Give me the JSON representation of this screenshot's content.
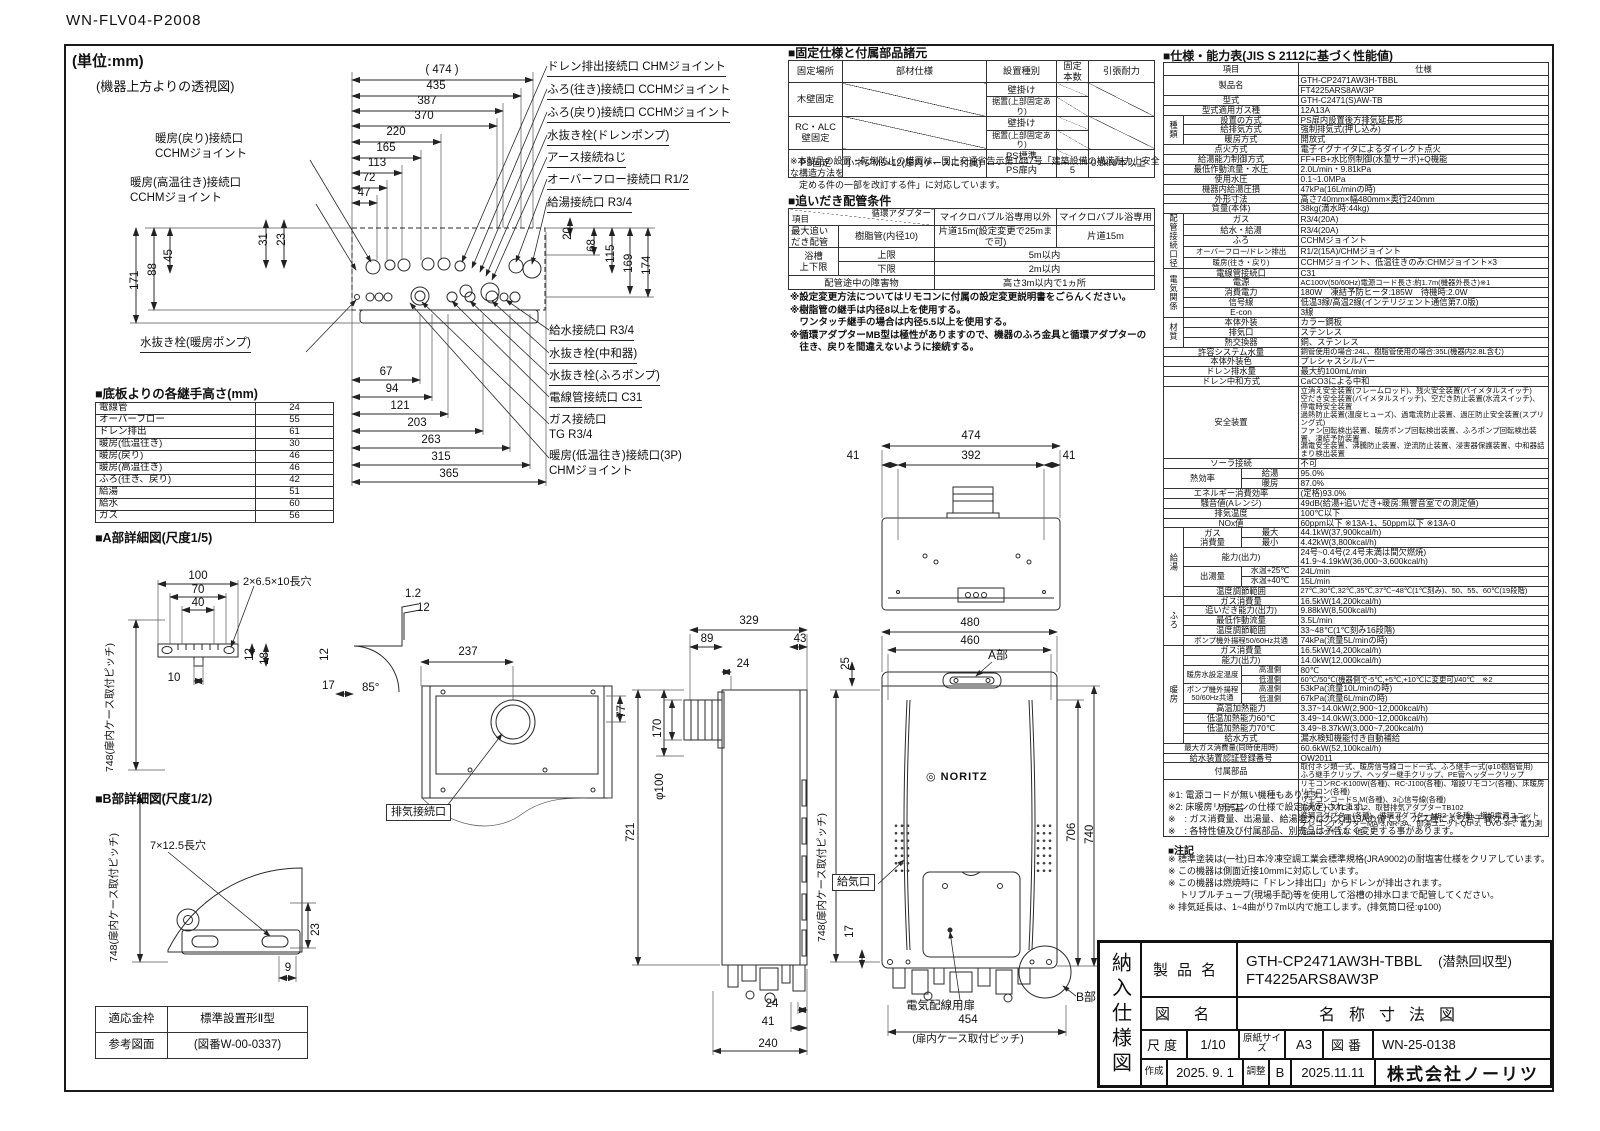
{
  "doc": {
    "code": "WN-FLV04-P2008",
    "unit": "(単位:mm)",
    "top_caption": "(機器上方よりの透視図)"
  },
  "top_view": {
    "dims_top": [
      "( 474 )",
      "435",
      "387",
      "370",
      "220",
      "165",
      "113",
      "72",
      "47"
    ],
    "dims_left": [
      "31",
      "23",
      "88",
      "45",
      "171"
    ],
    "dims_right": [
      "20",
      "68",
      "115",
      "169",
      "174"
    ],
    "dims_bottom": [
      "67",
      "94",
      "121",
      "203",
      "263",
      "315",
      "365"
    ],
    "labels_left": [
      "暖房(戻り)接続口\nCCHMジョイント",
      "暖房(高温往き)接続口\nCCHMジョイント",
      "水抜き栓(暖房ポンプ)"
    ],
    "labels_right": [
      "ドレン排出接続口 CHMジョイント",
      "ふろ(往き)接続口 CCHMジョイント",
      "ふろ(戻り)接続口 CCHMジョイント",
      "水抜き栓(ドレンポンプ)",
      "アース接続ねじ",
      "オーバーフロー接続口 R1/2",
      "給湯接続口 R3/4"
    ],
    "labels_right2": [
      "給水接続口 R3/4",
      "水抜き栓(中和器)",
      "水抜き栓(ふろポンプ)",
      "電線管接続口 C31",
      "ガス接続口\nTG R3/4",
      "暖房(低温往き)接続口(3P)\nCHMジョイント"
    ]
  },
  "joint_heights": {
    "title": "■底板よりの各継手高さ(mm)",
    "rows": [
      [
        "電線管",
        "24"
      ],
      [
        "オーバーフロー",
        "55"
      ],
      [
        "ドレン排出",
        "61"
      ],
      [
        "暖房(低温往き)",
        "30"
      ],
      [
        "暖房(戻り)",
        "46"
      ],
      [
        "暖房(高温往き)",
        "46"
      ],
      [
        "ふろ(往き、戻り)",
        "42"
      ],
      [
        "給湯",
        "51"
      ],
      [
        "給水",
        "60"
      ],
      [
        "ガス",
        "56"
      ]
    ]
  },
  "detail_a": {
    "title": "■A部詳細図(尺度1/5)",
    "pitch_full": "748(扉内ケース取付ピッチ)",
    "hole": "2×6.5×10長穴",
    "dims": [
      "100",
      "70",
      "40",
      "10",
      "12",
      "18",
      "1.2",
      "12",
      "12",
      "17",
      "85°"
    ]
  },
  "detail_b": {
    "title": "■B部詳細図(尺度1/2)",
    "pitch_full": "748(扉内ケース取付ピッチ)",
    "hole": "7×12.5長穴",
    "dims": [
      "23",
      "9"
    ]
  },
  "frame_table": {
    "rows": [
      [
        "適応金枠",
        "標準設置形Ⅱ型"
      ],
      [
        "参考図面",
        "(図番W-00-0337)"
      ]
    ]
  },
  "rear_view": {
    "dims": [
      "237",
      "77"
    ],
    "exhaust_label": "排気接続口"
  },
  "side_view": {
    "dims": [
      "329",
      "89",
      "43",
      "24",
      "170",
      "φ100",
      "721",
      "24",
      "41",
      "240"
    ]
  },
  "front_view": {
    "dims_top": [
      "474",
      "41",
      "392",
      "41"
    ],
    "dims": [
      "480",
      "460",
      "25",
      "706",
      "740",
      "17",
      "454"
    ],
    "pitch_full": "748(扉内ケース取付ピッチ)",
    "pitch454_note": "(扉内ケース取付ピッチ)",
    "labels": {
      "a": "A部",
      "b": "B部",
      "air": "給気口",
      "door": "電気配線用扉",
      "logo_mark": "◎",
      "logo": "NORITZ"
    }
  },
  "fixing": {
    "title": "■固定仕様と付属部品諸元",
    "headers": [
      "固定場所",
      "部材仕様",
      "設置種別",
      "固定本数",
      "引張耐力"
    ],
    "rows": [
      [
        {
          "t": "木壁固定",
          "rs": 2
        },
        {
          "t": "",
          "rs": 2,
          "cls": "diag"
        },
        {
          "t": "壁掛け"
        },
        {
          "t": "",
          "cls": "diag"
        },
        {
          "t": "",
          "rs": 2,
          "cls": "diag"
        }
      ],
      [
        {
          "t": "据置(上部固定あり)",
          "cls": "sm"
        },
        {
          "t": "",
          "cls": "diag"
        }
      ],
      [
        {
          "t": "RC・ALC\n壁固定",
          "rs": 2
        },
        {
          "t": "",
          "rs": 2,
          "cls": "diag"
        },
        {
          "t": "壁掛け"
        },
        {
          "t": "",
          "cls": "diag"
        },
        {
          "t": "",
          "rs": 2,
          "cls": "diag"
        }
      ],
      [
        {
          "t": "据置(上部固定あり)",
          "cls": "sm"
        },
        {
          "t": "",
          "cls": "diag"
        }
      ],
      [
        {
          "t": "PS固定",
          "rs": 2
        },
        {
          "t": "小ネジM5×12(扉内ケースに付属)",
          "rs": 2,
          "cls": "l"
        },
        {
          "t": "PS標準"
        },
        {
          "t": "",
          "cls": "diag"
        },
        {
          "t": "0.5kN/本以上",
          "rs": 2,
          "cls": "l"
        }
      ],
      [
        {
          "t": "PS扉内"
        },
        {
          "t": "5"
        }
      ]
    ],
    "note": "※本製品の設置・転倒防止の措置は、国土交通省告示第1447号「建築設備の構造耐力上安全な構造方法を\n　定める件の一部を改訂する件」に対応しています。"
  },
  "reheat": {
    "title": "■追いだき配管条件",
    "h_item": "項目",
    "h_adapter": "循環アダプター",
    "h_col1": "マイクロバブル浴専用以外",
    "h_col2": "マイクロバブル浴専用",
    "r1_label": "最大追い\nだき配管",
    "r1_adapter": "樹脂管(内径10)",
    "r1_v1": "片道15m(設定変更で25mまで可)",
    "r1_v2": "片道15m",
    "r2_label": "浴槽\n上下限",
    "r2_upper": "上限",
    "r2_upper_v": "5m以内",
    "r2_lower": "下限",
    "r2_lower_v": "2m以内",
    "r3_label": "配管途中の障害物",
    "r3_v": "高さ3m以内で1ヵ所",
    "notes": "※設定変更方法についてはリモコンに付属の設定変更説明書をごらんください。\n※樹脂管の継手は内径8以上を使用する。\n　ワンタッチ継手の場合は内径5.5以上を使用する。\n※循環アダプターMB型は極性がありますので、機器のふろ金具と循環アダプターの\n　往き、戻りを間違えないように接続する。"
  },
  "spec": {
    "title": "■仕様・能力表(JIS S 2112に基づく性能値)",
    "h_item": "項目",
    "h_val": "仕様",
    "rows": [
      [
        {
          "t": "製品名",
          "cs": 3,
          "rs": 2
        },
        {
          "t": "GTH-CP2471AW3H-TBBL",
          "cls": "l"
        }
      ],
      [
        {
          "t": "FT4225ARS8AW3P",
          "cls": "l"
        }
      ],
      [
        {
          "t": "型式",
          "cs": 3
        },
        {
          "t": "GTH-C2471(S)AW-TB",
          "cls": "l"
        }
      ],
      [
        {
          "t": "型式適用ガス種",
          "cs": 3
        },
        {
          "t": "12A13A",
          "cls": "l"
        }
      ],
      [
        {
          "t": "種類",
          "rs": 3
        },
        {
          "t": "設置の方式",
          "cs": 2
        },
        {
          "t": "PS扉内設置後方排気延長形",
          "cls": "l"
        }
      ],
      [
        {
          "t": "給排気方式",
          "cs": 2
        },
        {
          "t": "強制排気式(押し込み)",
          "cls": "l"
        }
      ],
      [
        {
          "t": "暖房方式",
          "cs": 2
        },
        {
          "t": "開放式",
          "cls": "l"
        }
      ],
      [
        {
          "t": "点火方式",
          "cs": 3
        },
        {
          "t": "電子イグナイタによるダイレクト点火",
          "cls": "l"
        }
      ],
      [
        {
          "t": "給湯能力制御方式",
          "cs": 3
        },
        {
          "t": "FF+FB+水比例制御(水量サーボ)+Q機能",
          "cls": "l"
        }
      ],
      [
        {
          "t": "最低作動流量・水圧",
          "cs": 3
        },
        {
          "t": "2.0L/min・9.81kPa",
          "cls": "l"
        }
      ],
      [
        {
          "t": "使用水圧",
          "cs": 3
        },
        {
          "t": "0.1~1.0MPa",
          "cls": "l"
        }
      ],
      [
        {
          "t": "機器内給湯圧損",
          "cs": 3
        },
        {
          "t": "47kPa(16L/minの時)",
          "cls": "l"
        }
      ],
      [
        {
          "t": "外形寸法",
          "cs": 3
        },
        {
          "t": "高さ740mm×幅480mm×奥行240mm",
          "cls": "l"
        }
      ],
      [
        {
          "t": "質量(本体)",
          "cs": 3
        },
        {
          "t": "38kg(満水時:44kg)",
          "cls": "l"
        }
      ],
      [
        {
          "t": "配管\n接続口径",
          "rs": 5
        },
        {
          "t": "ガス",
          "cs": 2
        },
        {
          "t": "R3/4(20A)",
          "cls": "l"
        }
      ],
      [
        {
          "t": "給水・給湯",
          "cs": 2
        },
        {
          "t": "R3/4(20A)",
          "cls": "l"
        }
      ],
      [
        {
          "t": "ふろ",
          "cs": 2
        },
        {
          "t": "CCHMジョイント",
          "cls": "l"
        }
      ],
      [
        {
          "t": "オーバーフロー/ドレン排出",
          "cs": 2,
          "cls": "xs"
        },
        {
          "t": "R1/2(15A)/CHMジョイント",
          "cls": "l"
        }
      ],
      [
        {
          "t": "暖房(往き・戻り)",
          "cs": 2,
          "cls": "xs"
        },
        {
          "t": "CCHMジョイント、低温往きのみ:CHMジョイント×3",
          "cls": "l"
        }
      ],
      [
        {
          "t": "電気関係",
          "rs": 5
        },
        {
          "t": "電線管接続口",
          "cs": 2
        },
        {
          "t": "C31",
          "cls": "l"
        }
      ],
      [
        {
          "t": "電源",
          "cs": 2
        },
        {
          "t": "AC100V(50/60Hz)電源コード長さ:約1.7m(機器外長さ)※1",
          "cls": "l xs"
        }
      ],
      [
        {
          "t": "消費電力",
          "cs": 2
        },
        {
          "t": "180W　凍結予防ヒータ:185W　待機時:2.0W",
          "cls": "l"
        }
      ],
      [
        {
          "t": "信号線",
          "cs": 2
        },
        {
          "t": "低温3線/高温2線(インテリジェント通信第7.0版)",
          "cls": "l"
        }
      ],
      [
        {
          "t": "E-con",
          "cs": 2
        },
        {
          "t": "3線",
          "cls": "l"
        }
      ],
      [
        {
          "t": "材質",
          "rs": 3
        },
        {
          "t": "本体外装",
          "cs": 2
        },
        {
          "t": "カラー鋼板",
          "cls": "l"
        }
      ],
      [
        {
          "t": "排気口",
          "cs": 2
        },
        {
          "t": "ステンレス",
          "cls": "l"
        }
      ],
      [
        {
          "t": "熱交換器",
          "cs": 2
        },
        {
          "t": "銅、ステンレス",
          "cls": "l"
        }
      ],
      [
        {
          "t": "許容システム水量",
          "cs": 3
        },
        {
          "t": "銅管使用の場合:24L、樹脂管使用の場合:35L(機器内2.8L含む)",
          "cls": "l xs"
        }
      ],
      [
        {
          "t": "本体外装色",
          "cs": 3
        },
        {
          "t": "プレシャスシルバー",
          "cls": "l"
        }
      ],
      [
        {
          "t": "ドレン排水量",
          "cs": 3
        },
        {
          "t": "最大約100mL/min",
          "cls": "l"
        }
      ],
      [
        {
          "t": "ドレン中和方式",
          "cs": 3
        },
        {
          "t": "CaCO3による中和",
          "cls": "l"
        }
      ],
      [
        {
          "t": "安全装置",
          "cs": 3
        },
        {
          "t": "立消え安全装置(フレームロッド)、残火安全装置(バイメタルスイッチ)\n空だき安全装置(バイメタルスイッチ)、空だき防止装置(水流スイッチ)、停電時安全装置\n過熱防止装置(温度ヒューズ)、過電流防止装置、過圧防止安全装置(スプリング式)\nファン回転検出装置、暖房ポンプ回転検出装置、ふろポンプ回転検出装置、凍結予防装置\n漏電安全装置、沸騰防止装置、逆流防止装置、浸害器保護装置、中和器詰まり検出装置",
          "cls": "l xs"
        }
      ],
      [
        {
          "t": "ソーラ接続",
          "cs": 3
        },
        {
          "t": "不可",
          "cls": "l"
        }
      ],
      [
        {
          "t": "熱効率",
          "cs": 2,
          "rs": 2
        },
        {
          "t": "給湯"
        },
        {
          "t": "95.0%",
          "cls": "l"
        }
      ],
      [
        {
          "t": "暖房"
        },
        {
          "t": "87.0%",
          "cls": "l"
        }
      ],
      [
        {
          "t": "エネルギー消費効率",
          "cs": 3
        },
        {
          "t": "(定格)93.0%",
          "cls": "l"
        }
      ],
      [
        {
          "t": "騒音値(Aレンジ)",
          "cs": 3
        },
        {
          "t": "49dB(給湯+追いだき+暖房:無響音室での測定値)",
          "cls": "l"
        }
      ],
      [
        {
          "t": "排気温度",
          "cs": 3
        },
        {
          "t": "100℃以下",
          "cls": "l"
        }
      ],
      [
        {
          "t": "NOx値",
          "cs": 3
        },
        {
          "t": "60ppm以下 ※13A-1、50ppm以下 ※13A-0",
          "cls": "l"
        }
      ],
      [
        {
          "t": "給湯",
          "rs": 6,
          "cls": "v"
        },
        {
          "t": "ガス\n消費量",
          "rs": 2
        },
        {
          "t": "最大"
        },
        {
          "t": "44.1kW(37,900kcal/h)",
          "cls": "l"
        }
      ],
      [
        {
          "t": "最小"
        },
        {
          "t": "4.42kW(3,800kcal/h)",
          "cls": "l"
        }
      ],
      [
        {
          "t": "能力(出力)",
          "cs": 2
        },
        {
          "t": "24号~0.4号(2.4号未満は間欠燃焼)\n41.9~4.19kW(36,000~3,600kcal/h)",
          "cls": "l"
        }
      ],
      [
        {
          "t": "出湯量",
          "rs": 2
        },
        {
          "t": "水温+25℃",
          "cls": "sm"
        },
        {
          "t": "24L/min",
          "cls": "l"
        }
      ],
      [
        {
          "t": "水温+40℃",
          "cls": "sm"
        },
        {
          "t": "15L/min",
          "cls": "l"
        }
      ],
      [
        {
          "t": "温度調節範囲",
          "cs": 2
        },
        {
          "t": "27℃,30℃,32℃,35℃,37℃~48℃(1℃刻み)、50、55、60℃(19段階)",
          "cls": "l xs"
        }
      ],
      [
        {
          "t": "ふろ",
          "rs": 5,
          "cls": "v"
        },
        {
          "t": "ガス消費量",
          "cs": 2
        },
        {
          "t": "16.5kW(14,200kcal/h)",
          "cls": "l"
        }
      ],
      [
        {
          "t": "追いだき能力(出力)",
          "cs": 2
        },
        {
          "t": "9.88kW(8,500kcal/h)",
          "cls": "l"
        }
      ],
      [
        {
          "t": "最低作動流量",
          "cs": 2
        },
        {
          "t": "3.5L/min",
          "cls": "l"
        }
      ],
      [
        {
          "t": "温度調節範囲",
          "cs": 2
        },
        {
          "t": "33~48℃(1℃刻み16段階)",
          "cls": "l"
        }
      ],
      [
        {
          "t": "ポンプ機外揚程50/60Hz共通",
          "cs": 2,
          "cls": "xs"
        },
        {
          "t": "74kPa(流量5L/minの時)",
          "cls": "l"
        }
      ],
      [
        {
          "t": "暖房",
          "rs": 10,
          "cls": "v"
        },
        {
          "t": "ガス消費量",
          "cs": 2
        },
        {
          "t": "16.5kW(14,200kcal/h)",
          "cls": "l"
        }
      ],
      [
        {
          "t": "能力(出力)",
          "cs": 2
        },
        {
          "t": "14.0kW(12,000kcal/h)",
          "cls": "l"
        }
      ],
      [
        {
          "t": "暖房水設定温度",
          "rs": 2,
          "cls": "xs"
        },
        {
          "t": "高温側",
          "cls": "xs"
        },
        {
          "t": "80℃",
          "cls": "l"
        }
      ],
      [
        {
          "t": "低温側",
          "cls": "xs"
        },
        {
          "t": "60℃/50℃(機器側で-5℃,+5℃,+10℃に変更可)/40℃　※2",
          "cls": "l xs"
        }
      ],
      [
        {
          "t": "ポンプ機外揚程\n50/60Hz共通",
          "rs": 2,
          "cls": "xs"
        },
        {
          "t": "高温側",
          "cls": "xs"
        },
        {
          "t": "53kPa(流量10L/minの時)",
          "cls": "l"
        }
      ],
      [
        {
          "t": "低温側",
          "cls": "xs"
        },
        {
          "t": "67kPa(流量6L/minの時)",
          "cls": "l"
        }
      ],
      [
        {
          "t": "高温加熱能力",
          "cs": 2
        },
        {
          "t": "3.37~14.0kW(2,900~12,000kcal/h)",
          "cls": "l"
        }
      ],
      [
        {
          "t": "低温加熱能力60℃",
          "cs": 2
        },
        {
          "t": "3.49~14.0kW(3,000~12,000kcal/h)",
          "cls": "l"
        }
      ],
      [
        {
          "t": "低温加熱能力70℃",
          "cs": 2
        },
        {
          "t": "3.49~8.37kW(3,000~7,200kcal/h)",
          "cls": "l"
        }
      ],
      [
        {
          "t": "給水方式",
          "cs": 2
        },
        {
          "t": "漏水検知機能付き自動補給",
          "cls": "l"
        }
      ],
      [
        {
          "t": "最大ガス消費量(同時使用時)",
          "cs": 3,
          "cls": "xs"
        },
        {
          "t": "60.6kW(52,100kcal/h)",
          "cls": "l"
        }
      ],
      [
        {
          "t": "給水装置認証登録番号",
          "cs": 3
        },
        {
          "t": "OW2011",
          "cls": "l"
        }
      ],
      [
        {
          "t": "付属部品",
          "cs": 3
        },
        {
          "t": "取付ネジ類一式、暖房信号線コード一式、ふろ継手一式(φ10樹脂管用)\nふろ継手クリップ、ヘッダー継手クリップ、PE管ヘッダークリップ",
          "cls": "l xs"
        }
      ],
      [
        {
          "t": "別売品",
          "cs": 3
        },
        {
          "t": "リモコンRC-K100W(各種)、RC-J100(各種)、増設リモコン(各種)、床暖房リモコン(各種)\nリモコンコードS,M(各種)、3心信号線(各種)\n扉内ケースTC-13,12、取替排気アダプターTB102\n循環アダプター(各種)、循環アダプターMB2-1(各種)、増設電源ユニット\nテレコンアダプターMA-3,NR-3A、即湯ユニットQU-3、DVU-3F、電力測定ユニット1,2　他",
          "cls": "l xs"
        }
      ]
    ],
    "notes": "※1: 電源コードが無い機種もあります。\n※2: 床暖房リモコンの仕様で設定(決定)されます。\n※　: ガス消費量、出湯量、給湯能力はガス種13Aの値です。ガス種により若干異なります。\n※　: 各特性値及び付属部品、別売品は予告なく変更する事があります。",
    "notes2_title": "■注記",
    "notes2": "※ 標準塗装は(一社)日本冷凍空調工業会標準規格(JRA9002)の耐塩害仕様をクリアしています。\n※ この機器は側面近接10mmに対応しています。\n※ この機器は燃焼時に「ドレン排出口」からドレンが排出されます。\n　 トリプルチューブ(現場手配)等を使用して浴槽の排水口まで配管してください。\n※ 排気延長は、1~4曲がり7m以内で施工します。(排気筒口径:φ100)"
  },
  "title_block": {
    "doc_type": "納入仕様図",
    "product_label": "製品名",
    "product_1": "GTH-CP2471AW3H-TBBL",
    "product_1b": "(潜熱回収型)",
    "product_2": "FT4225ARS8AW3P",
    "drawing_label": "図名",
    "drawing_name": "名称寸法図",
    "scale_label": "尺度",
    "scale": "1/10",
    "paper_label": "原紙サイズ",
    "paper": "A3",
    "number_label": "図番",
    "number": "WN-25-0138",
    "created_label": "作成",
    "created": "2025. 9. 1",
    "revised_label": "調整",
    "revision": "B",
    "revised": "2025.11.11",
    "company": "株式会社ノーリツ"
  }
}
